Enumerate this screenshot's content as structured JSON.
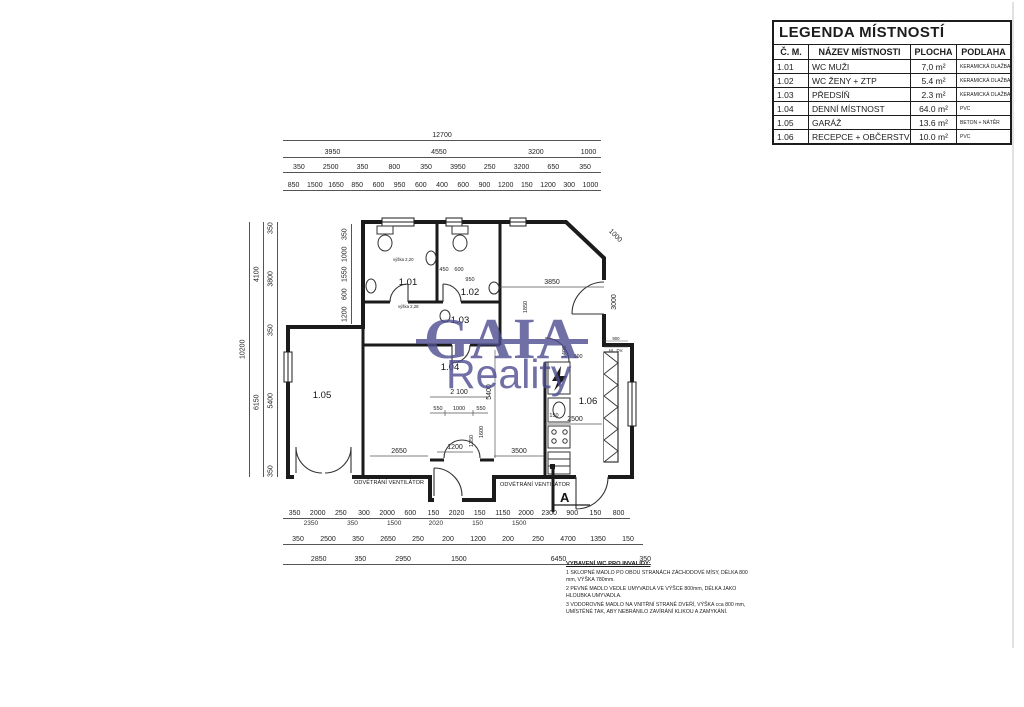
{
  "legend": {
    "title": "LEGENDA MÍSTNOSTÍ",
    "headers": [
      "Č. M.",
      "NÁZEV MÍSTNOSTI",
      "PLOCHA",
      "PODLAHA"
    ],
    "rows": [
      [
        "1.01",
        "WC MUŽI",
        "7,0 m²",
        "KERAMICKÁ DLAŽBA"
      ],
      [
        "1.02",
        "WC ŽENY + ZTP",
        "5.4 m²",
        "KERAMICKÁ DLAŽBA"
      ],
      [
        "1.03",
        "PŘEDSÍŇ",
        "2.3 m²",
        "KERAMICKÁ DLAŽBA"
      ],
      [
        "1.04",
        "DENNÍ MÍSTNOST",
        "64.0 m²",
        "PVC"
      ],
      [
        "1.05",
        "GARÁŽ",
        "13.6 m²",
        "BETON + NÁTĚR"
      ],
      [
        "1.06",
        "RECEPCE + OBČERSTVENÍ",
        "10.0 m²",
        "PVC"
      ]
    ]
  },
  "watermark": {
    "line1": "GAIA",
    "line2": "Reality",
    "color": "#4d4d90"
  },
  "plan": {
    "rooms": [
      "1.01",
      "1.02",
      "1.03",
      "1.04",
      "1.05",
      "1.06"
    ],
    "dims": {
      "t0": [
        "12700"
      ],
      "t1": [
        "3950",
        "4550",
        "3200",
        "1000"
      ],
      "t2": [
        "350",
        "2500",
        "350",
        "800",
        "350",
        "3950",
        "250",
        "3200",
        "650",
        "350"
      ],
      "t3": [
        "850",
        "1500",
        "1650",
        "850",
        "600",
        "950",
        "600",
        "400",
        "600",
        "900",
        "1200",
        "150",
        "1200",
        "300",
        "1000"
      ],
      "l0": [
        "10200"
      ],
      "l1": [
        "4100",
        "6150"
      ],
      "l2": [
        "350",
        "3800",
        "350",
        "5400",
        "350"
      ],
      "li": [
        "350",
        "1000",
        "1550",
        "600",
        "1200"
      ],
      "b1": [
        "350",
        "2000",
        "250",
        "300",
        "2000",
        "600",
        "150",
        "2020",
        "150",
        "1150",
        "2000",
        "2300",
        "900",
        "150",
        "800"
      ],
      "b1s": [
        "2350",
        "350",
        "1500",
        "2020",
        "150",
        "1500"
      ],
      "b2": [
        "350",
        "2500",
        "350",
        "2650",
        "250",
        "200",
        "1200",
        "200",
        "250",
        "4700",
        "1350",
        "150"
      ],
      "b3": [
        "2850",
        "350",
        "2950",
        "1500",
        "6450",
        "350"
      ],
      "inner": [
        "3850",
        "1000",
        "3000",
        "5400",
        "2 100",
        "550",
        "1000",
        "550",
        "1200",
        "2650",
        "3500",
        "2500",
        "150",
        "1400",
        "300",
        "950",
        "450",
        "600",
        "1600",
        "1350",
        "1850"
      ]
    },
    "labels": {
      "vent_left": "ODVĚTRÁNÍ VENTILÁTOR",
      "vent_right": "ODVĚTRÁNÍ VENTILÁTOR",
      "section": "A",
      "door_spec": [
        "900",
        "1970",
        "HL. DV."
      ],
      "height_note_1": "výška 2,20",
      "height_note_2": "výška 2,28"
    },
    "notes": {
      "heading": "VYBAVENÍ WC PRO INVALIDY:",
      "items": [
        "1 SKLOPNÉ MADLO PO OBOU STRANÁCH ZÁCHODOVÉ MÍSY, DÉLKA 800 mm, VÝŠKA 780mm.",
        "2 PEVNÉ MADLO VEDLE UMYVADLA VE VÝŠCE 800mm, DÉLKA JAKO HLOUBKA UMYVADLA.",
        "3 VODOROVNÉ MADLO NA VNITŘNÍ STRANĚ DVEŘÍ, VÝŠKA cca 800 mm, UMÍSTĚNÉ TAK, ABY NEBRÁNILO ZAVÍRÁNÍ KLIKOU A ZAMYKÁNÍ."
      ]
    }
  }
}
